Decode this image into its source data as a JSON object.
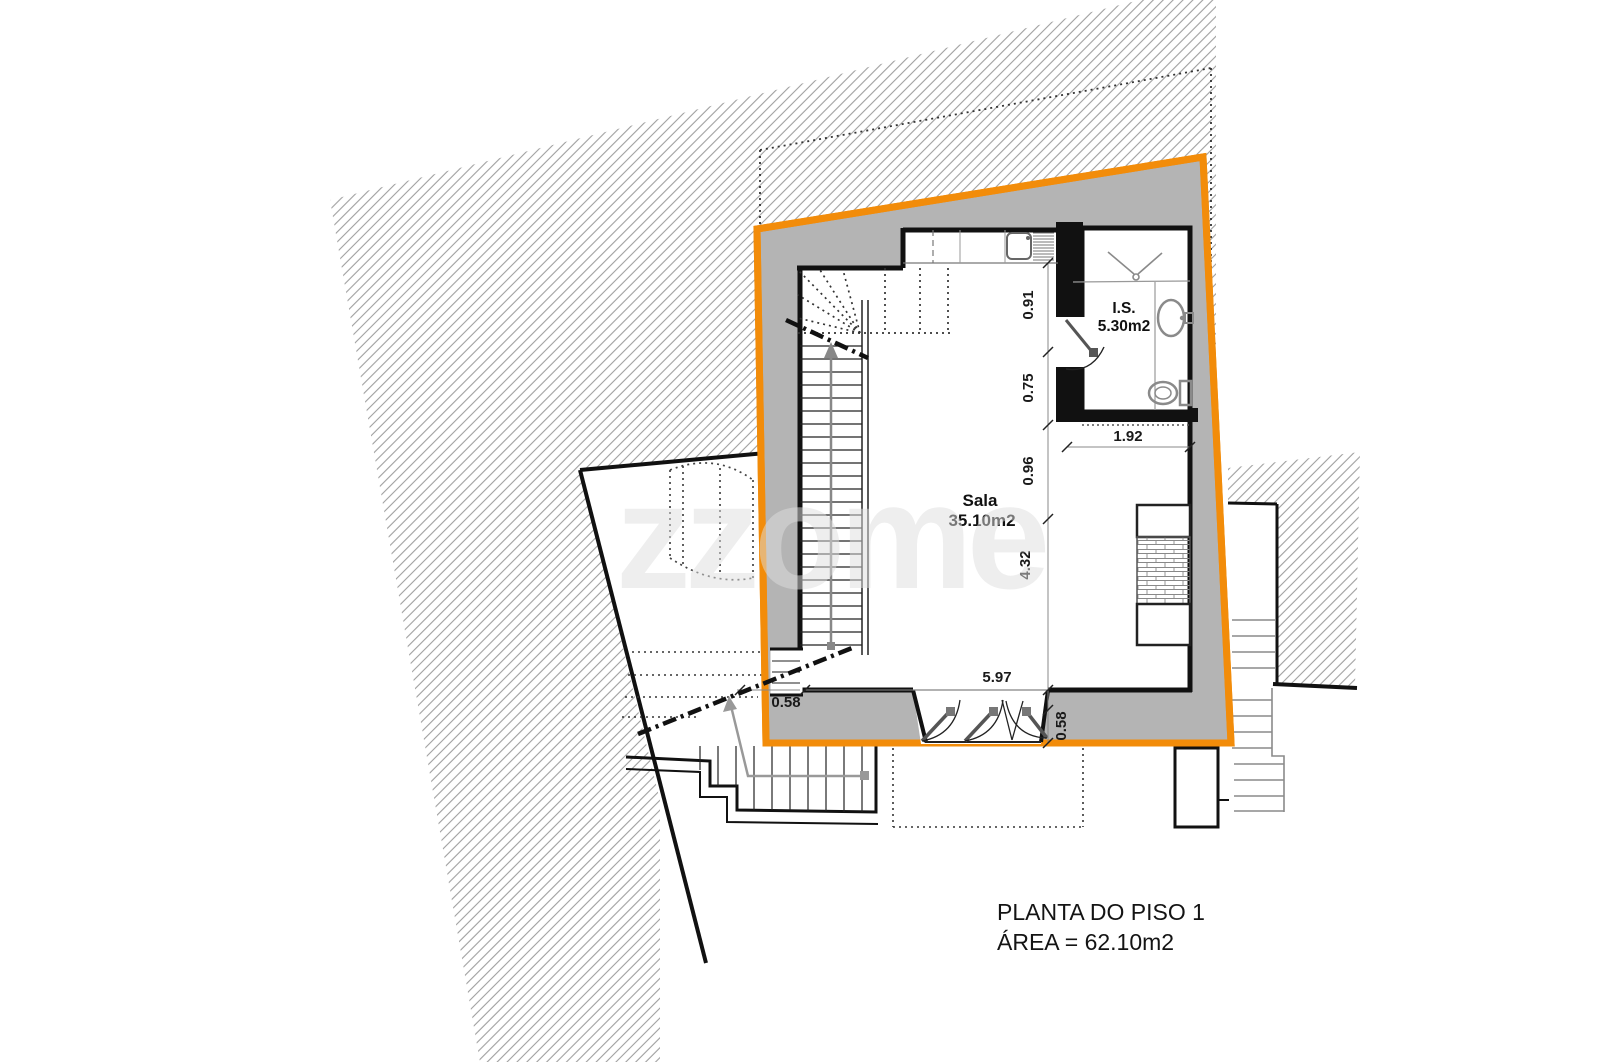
{
  "title_block": {
    "line1": "PLANTA DO PISO 1",
    "line2": "ÁREA = 62.10m2"
  },
  "rooms": {
    "sala": {
      "name": "Sala",
      "area": "35.10m2"
    },
    "is": {
      "name": "I.S.",
      "area": "5.30m2"
    }
  },
  "dims": {
    "v_091": "0.91",
    "v_075": "0.75",
    "v_096": "0.96",
    "v_432": "4.32",
    "h_192": "1.92",
    "h_597": "5.97",
    "left_058": "0.58",
    "right_058": "0.58"
  },
  "watermark": {
    "text": "zzome"
  },
  "colors": {
    "boundary_orange": "#F28C0A",
    "wall_gray": "#B4B4B4",
    "hatch_gray": "#9F9F9F"
  }
}
